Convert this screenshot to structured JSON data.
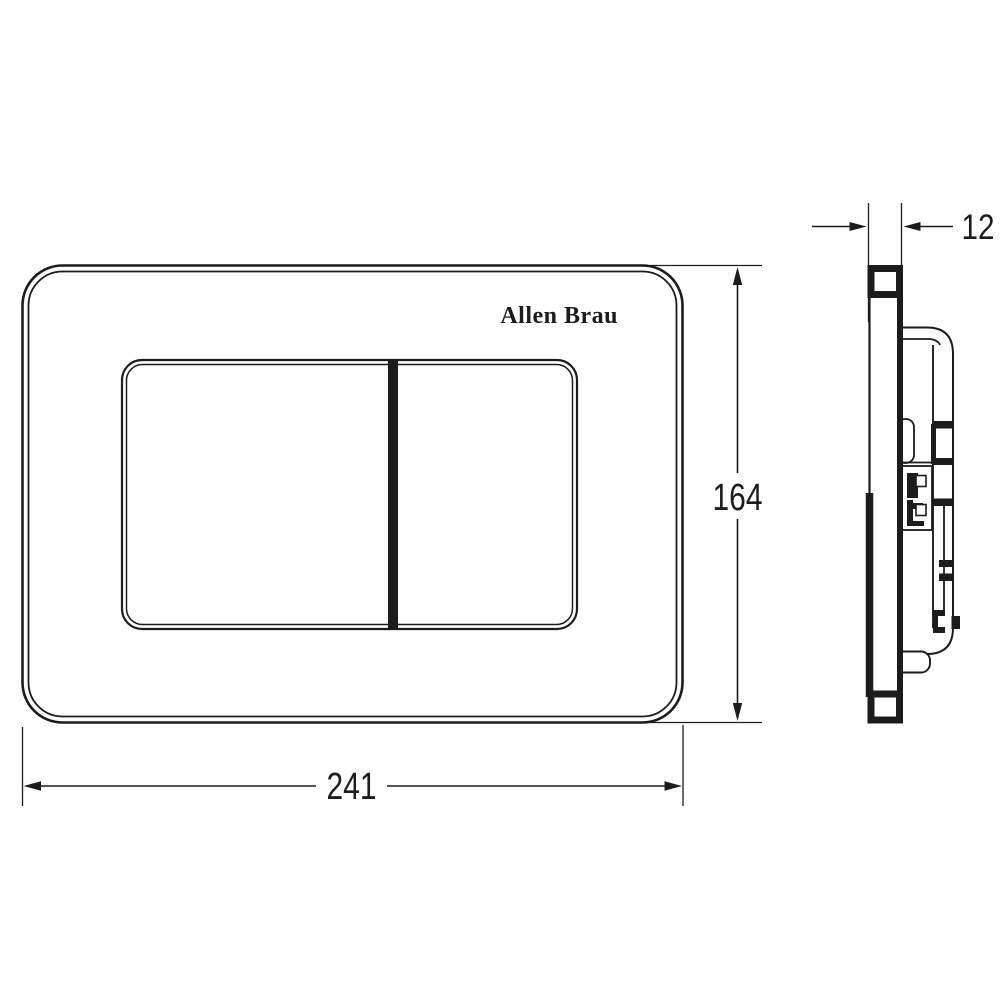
{
  "labels": {
    "brand": "Allen Brau",
    "width": "241",
    "height": "164",
    "thickness": "12"
  },
  "colors": {
    "line": "#1c1c1c",
    "background": "#ffffff",
    "paper": "#ffffff"
  }
}
